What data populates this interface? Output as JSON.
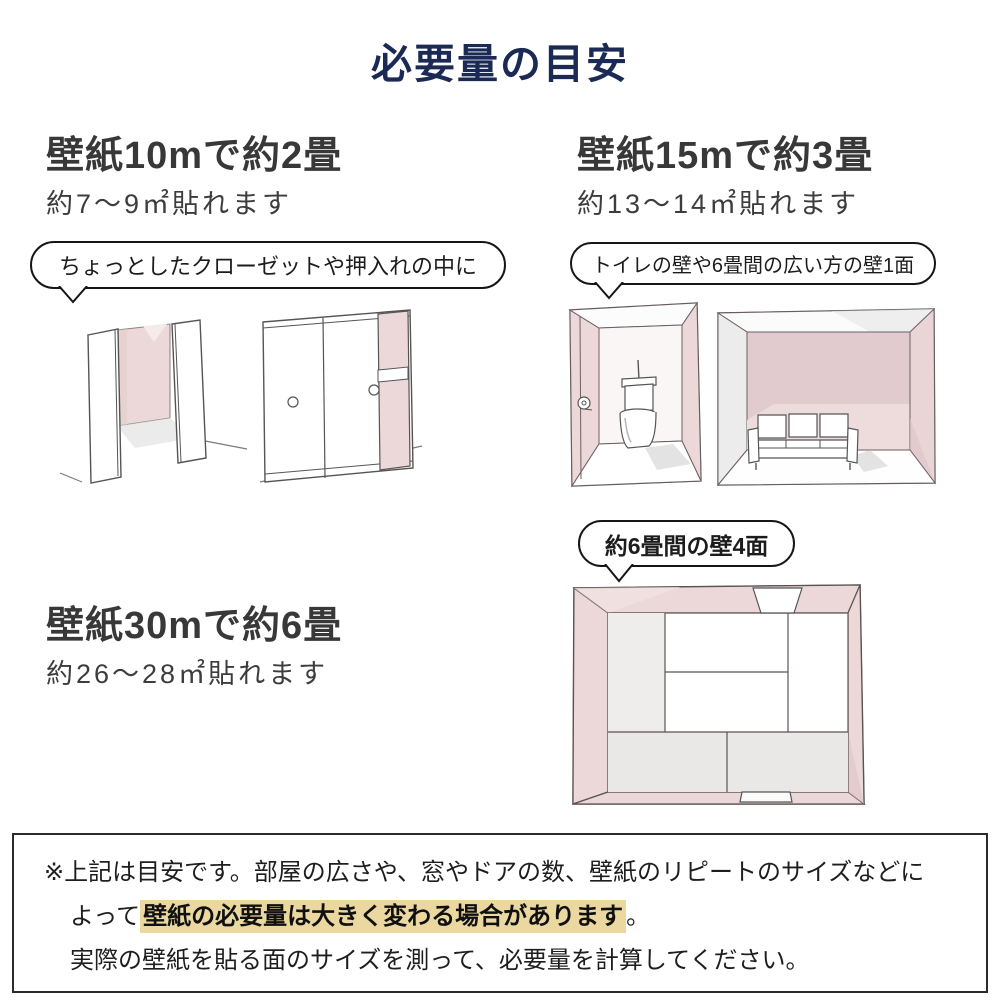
{
  "title": "必要量の目安",
  "colors": {
    "title_navy": "#1b2a54",
    "heading_gray": "#383838",
    "wall_pink": "#ecd8d8",
    "wall_pink_dark": "#e1cbce",
    "wall_gray": "#ececec",
    "tatami_gray": "#eae7e7",
    "highlight_yellow": "#ead8a0",
    "note_border": "#2b2b2b"
  },
  "sections": [
    {
      "heading": "壁紙10mで約2畳",
      "sub": "約7〜9㎡貼れます",
      "bubble": "ちょっとしたクローゼットや押入れの中に",
      "illustrations": [
        "open-closet",
        "sliding-door-closet"
      ]
    },
    {
      "heading": "壁紙15mで約3畳",
      "sub": "約13〜14㎡貼れます",
      "bubble": "トイレの壁や6畳間の広い方の壁1面",
      "illustrations": [
        "toilet-room",
        "six-mat-room-one-wall"
      ]
    },
    {
      "heading": "壁紙30mで約6畳",
      "sub": "約26〜28㎡貼れます",
      "bubble": "約6畳間の壁4面",
      "illustrations": [
        "six-mat-room-top-view"
      ]
    }
  ],
  "footnote": {
    "line1": "※上記は目安です。部屋の広さや、窓やドアの数、壁紙のリピートのサイズなどに",
    "line2_prefix": "よって",
    "line2_highlight": "壁紙の必要量は大きく変わる場合があります",
    "line2_suffix": "。",
    "line3": "実際の壁紙を貼る面のサイズを測って、必要量を計算してください。"
  }
}
